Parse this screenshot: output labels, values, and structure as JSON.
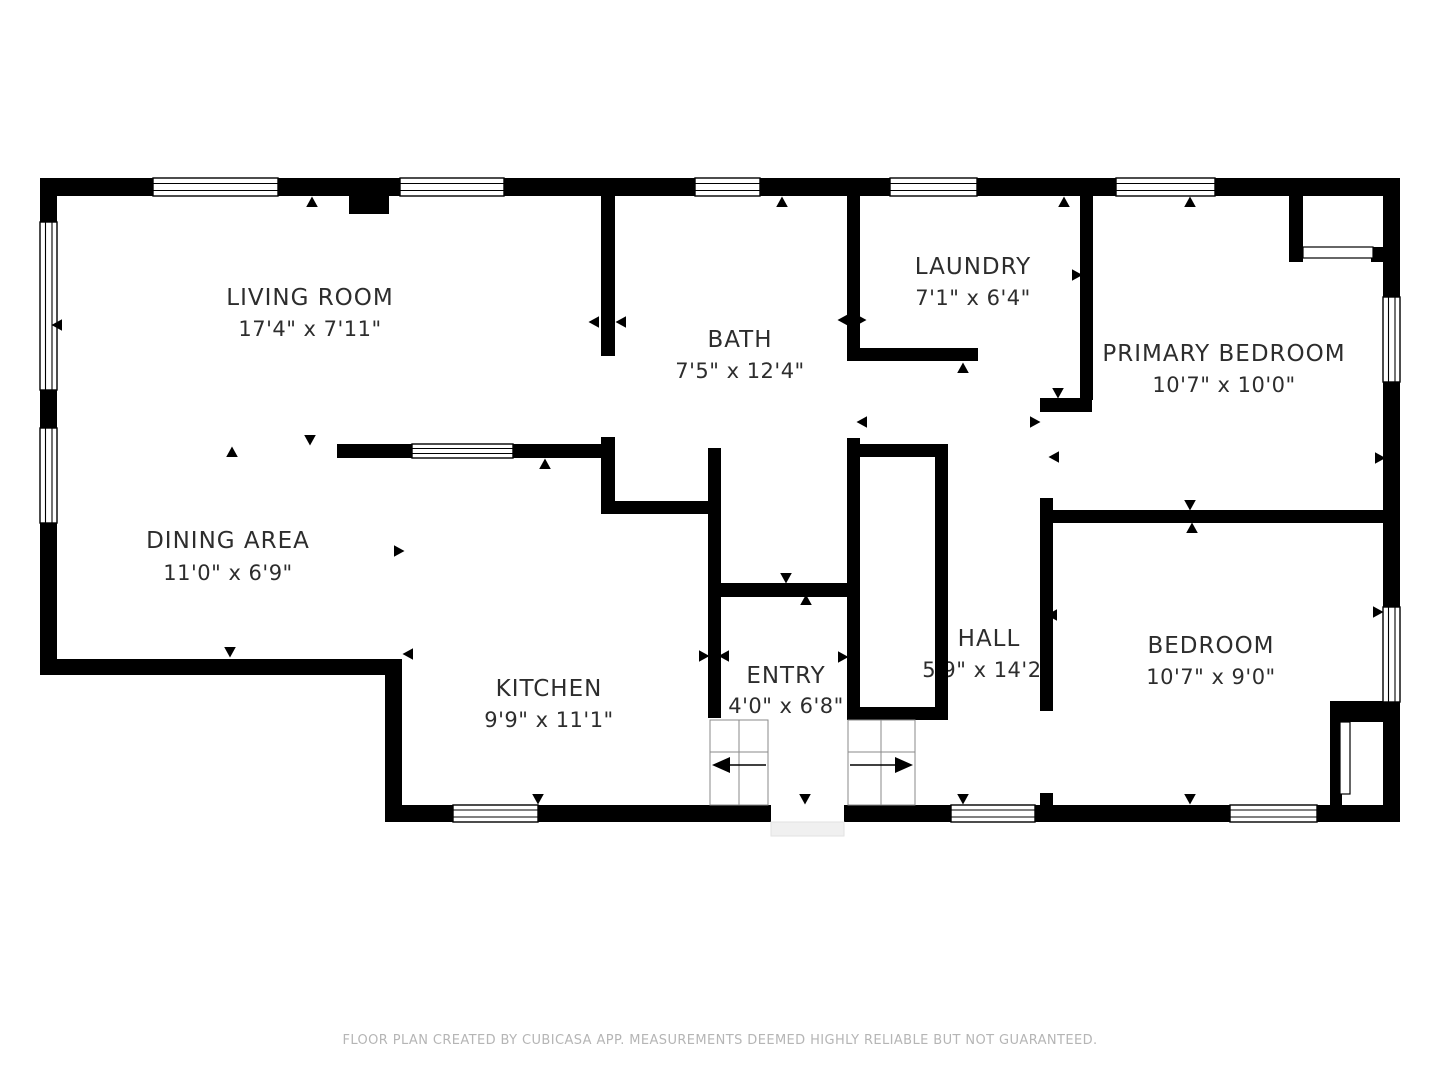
{
  "plan": {
    "app_name": "CUBICASA",
    "rooms": [
      {
        "name": "LIVING ROOM",
        "dims": "17'4\" x 7'11\""
      },
      {
        "name": "BATH",
        "dims": "7'5\" x 12'4\""
      },
      {
        "name": "LAUNDRY",
        "dims": "7'1\" x 6'4\""
      },
      {
        "name": "PRIMARY BEDROOM",
        "dims": "10'7\" x 10'0\""
      },
      {
        "name": "DINING AREA",
        "dims": "11'0\" x 6'9\""
      },
      {
        "name": "KITCHEN",
        "dims": "9'9\" x 11'1\""
      },
      {
        "name": "ENTRY",
        "dims": "4'0\" x 6'8\""
      },
      {
        "name": "HALL",
        "dims": "5'9\" x 14'2\""
      },
      {
        "name": "BEDROOM",
        "dims": "10'7\" x 9'0\""
      }
    ],
    "colors": {
      "wall": "#000000",
      "room_text": "#2d2d2d",
      "footer_text": "#b5b5b5"
    }
  },
  "footer": {
    "disclaimer": "FLOOR PLAN CREATED BY CUBICASA APP. MEASUREMENTS DEEMED HIGHLY RELIABLE BUT NOT GUARANTEED."
  }
}
